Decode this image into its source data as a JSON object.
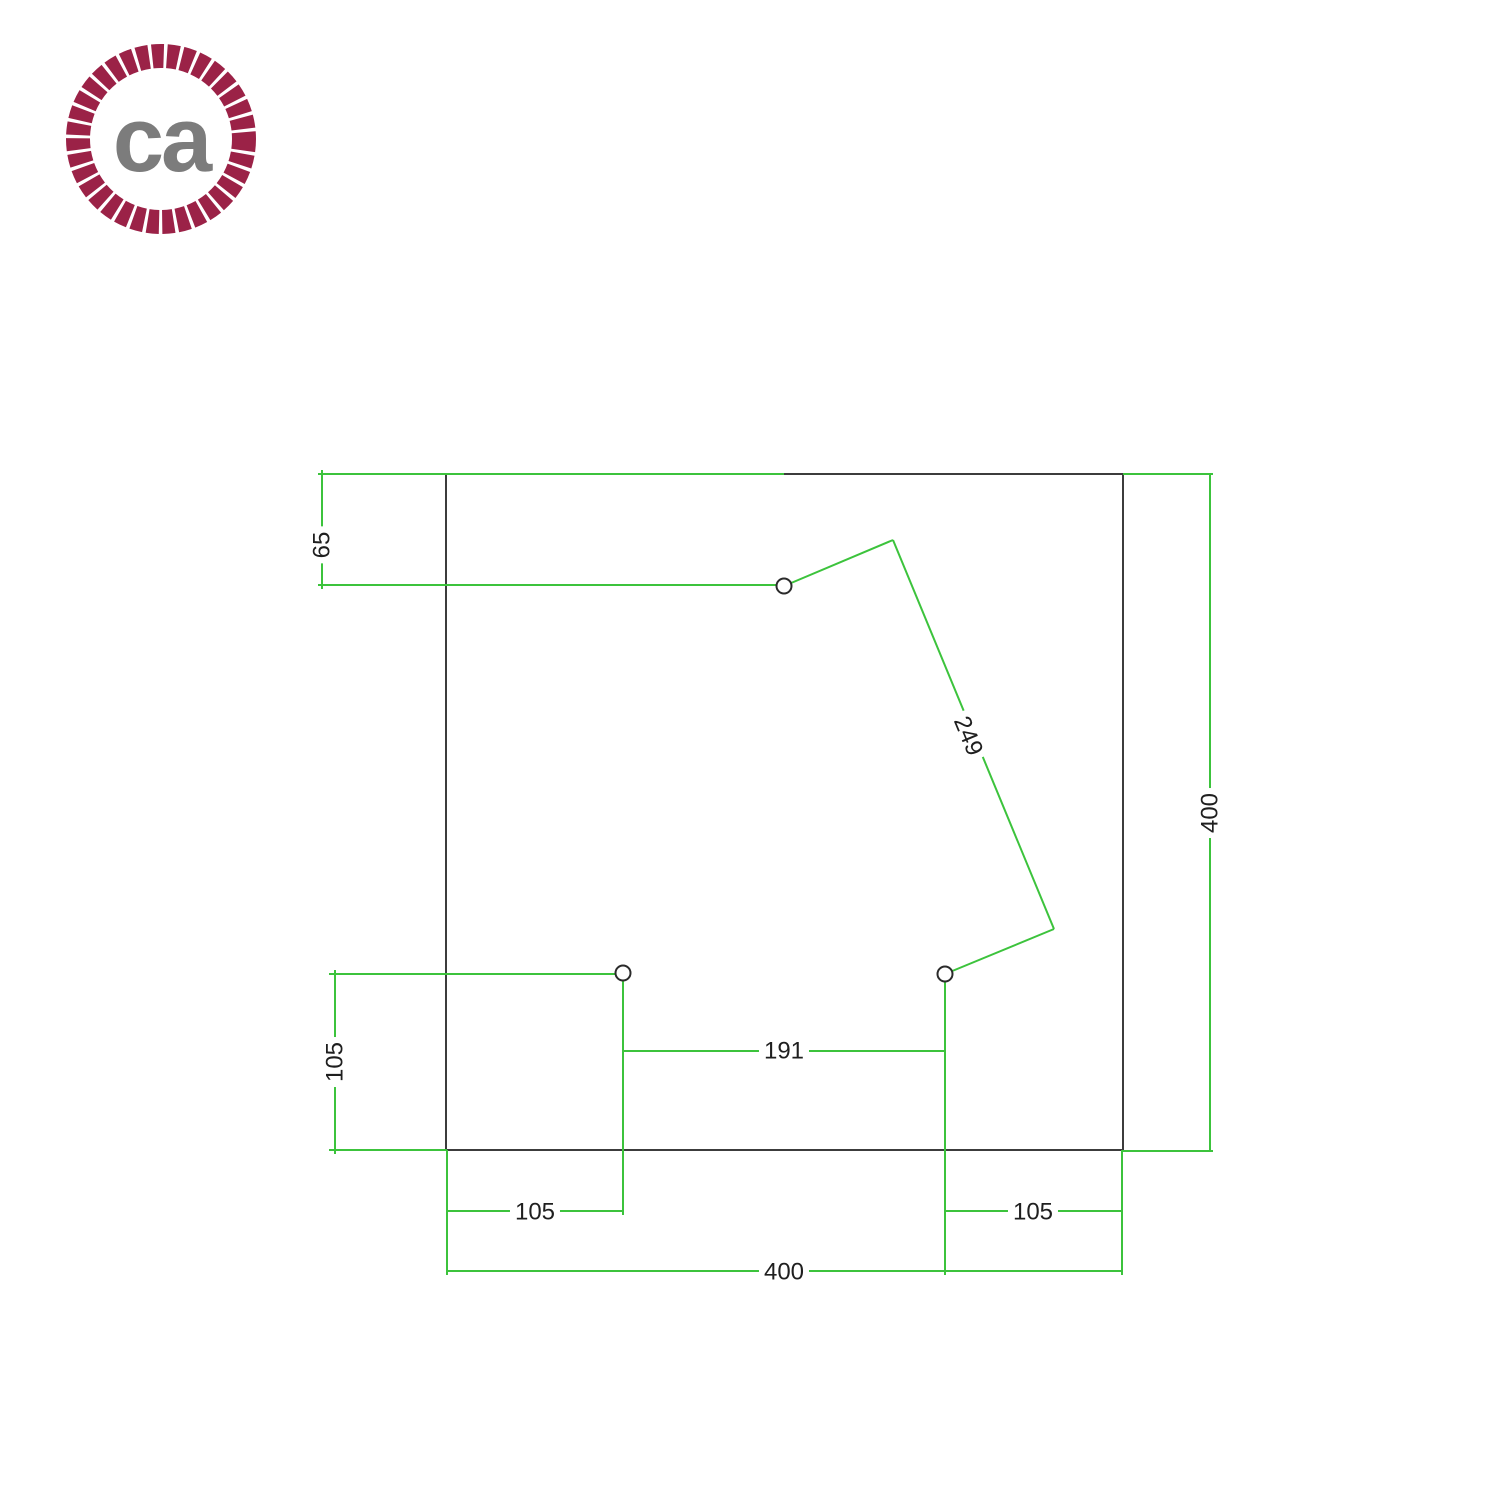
{
  "page": {
    "width": 1500,
    "height": 1500,
    "background": "#ffffff"
  },
  "logo": {
    "initials": "ca",
    "rope_color": "#9b2247",
    "initials_color": "#7c7c7c",
    "x": 65,
    "y": 43,
    "size": 192,
    "ring_radius": 83,
    "ring_thickness": 24,
    "dash": "11.5 3.2"
  },
  "drawing": {
    "description": "Square plate drilling diagram, 400 x 400, with three mounting holes",
    "colors": {
      "plate_outline": "#3c3c3c",
      "dimension": "#3cc33c",
      "label_text": "#1f1f1f",
      "hole_stroke": "#2b2b2b",
      "hole_fill": "#ffffff"
    },
    "plate": {
      "x": 446,
      "y": 474,
      "width": 677,
      "height": 676,
      "size_units": "400 x 400"
    },
    "holes": [
      {
        "name": "hole-top",
        "cx": 784,
        "cy": 586,
        "r": 7.5
      },
      {
        "name": "hole-bottom-left",
        "cx": 623,
        "cy": 973,
        "r": 7.5
      },
      {
        "name": "hole-bottom-right",
        "cx": 945,
        "cy": 974,
        "r": 7.5
      }
    ],
    "lines": [
      {
        "x1": 318,
        "y1": 474,
        "x2": 784,
        "y2": 474
      },
      {
        "x1": 318,
        "y1": 585,
        "x2": 780,
        "y2": 585
      },
      {
        "x1": 322,
        "y1": 470,
        "x2": 322,
        "y2": 589
      },
      {
        "x1": 329,
        "y1": 974,
        "x2": 620,
        "y2": 974
      },
      {
        "x1": 329,
        "y1": 1150,
        "x2": 447,
        "y2": 1150
      },
      {
        "x1": 335,
        "y1": 970,
        "x2": 335,
        "y2": 1154
      },
      {
        "x1": 623,
        "y1": 979,
        "x2": 623,
        "y2": 1215
      },
      {
        "x1": 447,
        "y1": 1211,
        "x2": 623,
        "y2": 1211
      },
      {
        "x1": 623,
        "y1": 1051,
        "x2": 945,
        "y2": 1051
      },
      {
        "x1": 945,
        "y1": 980,
        "x2": 945,
        "y2": 1275
      },
      {
        "x1": 945,
        "y1": 1211,
        "x2": 1122,
        "y2": 1211
      },
      {
        "x1": 447,
        "y1": 1150,
        "x2": 447,
        "y2": 1275
      },
      {
        "x1": 1122,
        "y1": 1150,
        "x2": 1122,
        "y2": 1275
      },
      {
        "x1": 447,
        "y1": 1271,
        "x2": 1122,
        "y2": 1271
      },
      {
        "x1": 1123,
        "y1": 474,
        "x2": 1213,
        "y2": 474
      },
      {
        "x1": 1122,
        "y1": 1151,
        "x2": 1213,
        "y2": 1151
      },
      {
        "x1": 1210,
        "y1": 474,
        "x2": 1210,
        "y2": 1151
      },
      {
        "x1": 784,
        "y1": 586,
        "x2": 893,
        "y2": 540
      },
      {
        "x1": 893,
        "y1": 540,
        "x2": 1054,
        "y2": 929
      },
      {
        "x1": 1054,
        "y1": 929,
        "x2": 945,
        "y2": 974
      }
    ],
    "labels": [
      {
        "text": "65",
        "x": 322,
        "y": 545,
        "rot": -90
      },
      {
        "text": "105",
        "x": 335,
        "y": 1062,
        "rot": -90
      },
      {
        "text": "105",
        "x": 535,
        "y": 1212,
        "rot": 0
      },
      {
        "text": "191",
        "x": 784,
        "y": 1051,
        "rot": 0
      },
      {
        "text": "105",
        "x": 1033,
        "y": 1212,
        "rot": 0
      },
      {
        "text": "400",
        "x": 784,
        "y": 1272,
        "rot": 0
      },
      {
        "text": "400",
        "x": 1210,
        "y": 813,
        "rot": -90
      },
      {
        "text": "249",
        "x": 968,
        "y": 736,
        "rot": 67.5
      }
    ]
  }
}
